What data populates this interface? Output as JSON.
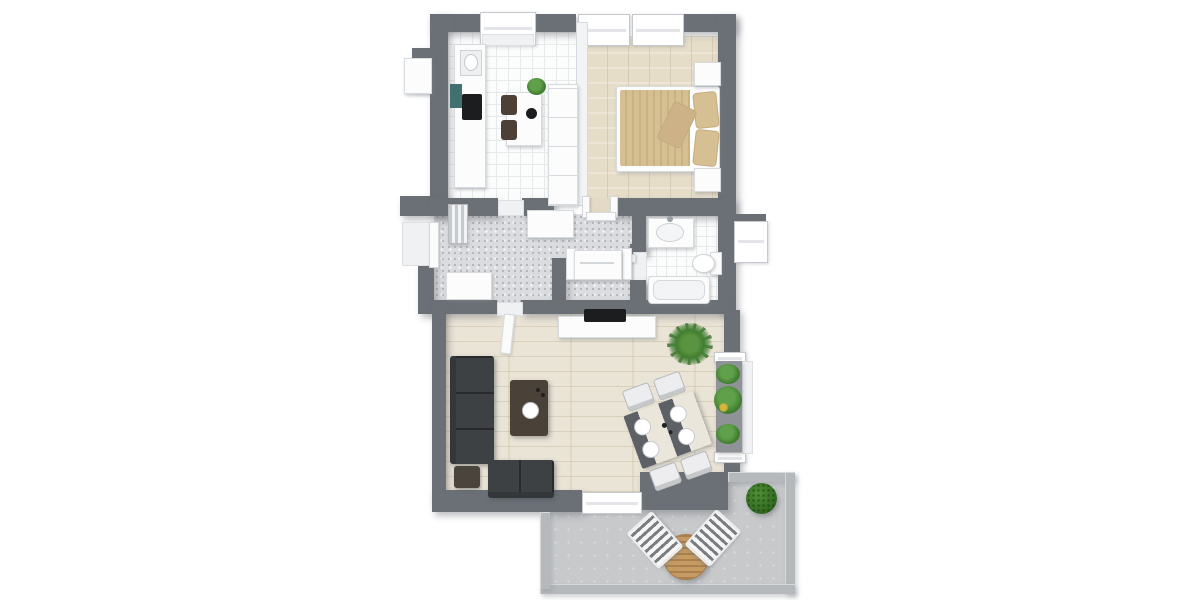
{
  "scene": {
    "type": "3d-apartment-floorplan-render",
    "background": "#ffffff",
    "canvas": {
      "width": 1200,
      "height": 600
    }
  },
  "palette": {
    "wall": "#6b7076",
    "wall_light": "#b6b9bc",
    "tile": "#fbfcfc",
    "carpet": "#dbdcdf",
    "wood_bedroom": "#e6ddc9",
    "wood_living": "#eae4d6",
    "concrete": "#c7c9cb",
    "sofa": "#3e4144",
    "coffee_table": "#4a4238",
    "chair_brown": "#4c4037",
    "bed_linen": "#d6bf93",
    "plant": "#4e8a3d",
    "tv": "#1c1d1f",
    "white_furniture": "#fcfcfd",
    "teal_accent": "#41706f",
    "terrace_table_wood": "#c59a63"
  },
  "rooms": [
    {
      "name": "kitchen",
      "floor": "white-tile",
      "furniture": [
        "balcony-door",
        "kitchen-counter",
        "sink",
        "cooktop",
        "teal-appliance-panel",
        "breakfast-table",
        "brown-chair",
        "brown-chair",
        "black-bowl",
        "potted-plant",
        "tall-cabinets"
      ]
    },
    {
      "name": "bedroom",
      "floor": "light-wood",
      "furniture": [
        "window",
        "window",
        "double-bed",
        "striped-duvet",
        "pillow",
        "pillow",
        "throw-pillow",
        "nightstand",
        "nightstand"
      ]
    },
    {
      "name": "hallway",
      "floor": "speckled-carpet",
      "furniture": [
        "entry-door",
        "radiator",
        "sideboard",
        "sideboard"
      ]
    },
    {
      "name": "storage-closet",
      "floor": "speckled-carpet",
      "furniture": [
        "washing-machine"
      ]
    },
    {
      "name": "bathroom",
      "floor": "white-tile",
      "furniture": [
        "washbasin-vanity",
        "toilet",
        "bathtub",
        "window-shelf"
      ]
    },
    {
      "name": "living-room",
      "floor": "light-wood",
      "furniture": [
        "corner-sofa",
        "ottoman",
        "coffee-table",
        "white-bowl",
        "tv-sideboard",
        "tv",
        "dining-table",
        "dining-chair",
        "dining-chair",
        "dining-chair",
        "dining-chair",
        "floor-plant",
        "plant-ledge",
        "potted-plant",
        "potted-plant",
        "potted-plant",
        "terrace-door"
      ]
    },
    {
      "name": "terrace",
      "floor": "concrete",
      "furniture": [
        "round-wood-table",
        "deck-chair",
        "deck-chair",
        "boxwood-bush"
      ]
    }
  ]
}
